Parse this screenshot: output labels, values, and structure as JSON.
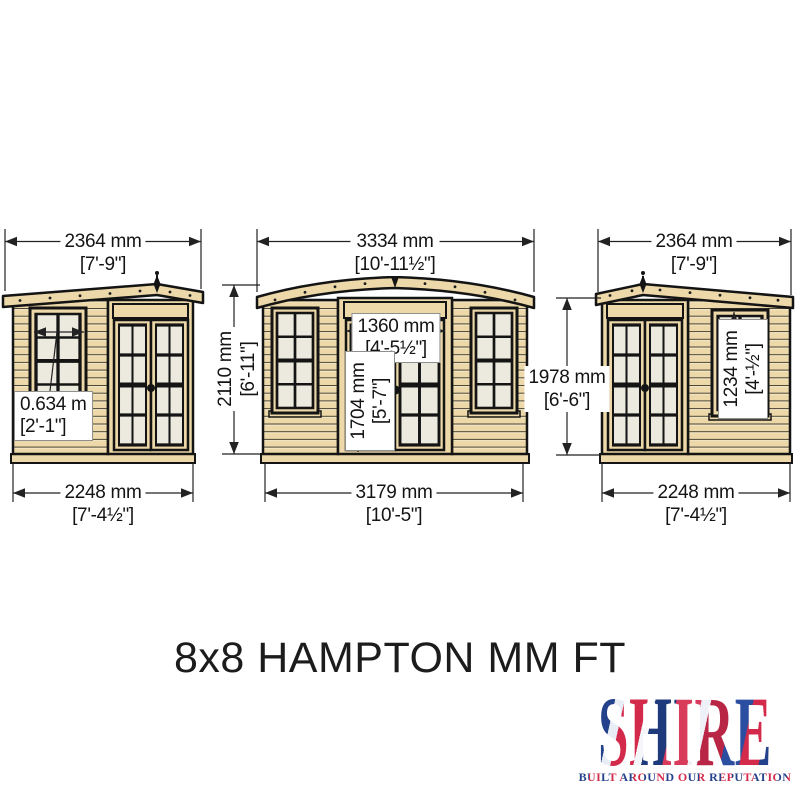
{
  "title": "8x8 HAMPTON MM FT",
  "colors": {
    "wood": "#ecd8a8",
    "glass": "#eceade",
    "outline": "#141414",
    "dimension_line": "#222222",
    "logo_red": "#d32a4b",
    "logo_blue": "#24418c"
  },
  "views": {
    "left": {
      "roof_width": {
        "mm": "2364 mm",
        "ft": "[7'-9\"]"
      },
      "window_width": {
        "mm": "0.634 m",
        "ft": "[2'-1\"]"
      },
      "base_width": {
        "mm": "2248 mm",
        "ft": "[7'-4½\"]"
      }
    },
    "front": {
      "roof_width": {
        "mm": "3334 mm",
        "ft": "[10'-11½\"]"
      },
      "door_width": {
        "mm": "1360 mm",
        "ft": "[4'-5½\"]"
      },
      "door_height": {
        "mm": "1704 mm",
        "ft": "[5'-7\"]"
      },
      "ridge_height": {
        "mm": "2110 mm",
        "ft": "[6'-11\"]"
      },
      "base_width": {
        "mm": "3179 mm",
        "ft": "[10'-5\"]"
      }
    },
    "right": {
      "roof_width": {
        "mm": "2364 mm",
        "ft": "[7'-9\"]"
      },
      "window_height": {
        "mm": "1234 mm",
        "ft": "[4'-½\"]"
      },
      "eaves_height": {
        "mm": "1978 mm",
        "ft": "[6'-6\"]"
      },
      "base_width": {
        "mm": "2248 mm",
        "ft": "[7'-4½\"]"
      }
    }
  },
  "logo": {
    "word": "SHIRE",
    "tagline": "BUILT AROUND OUR REPUTATION"
  }
}
